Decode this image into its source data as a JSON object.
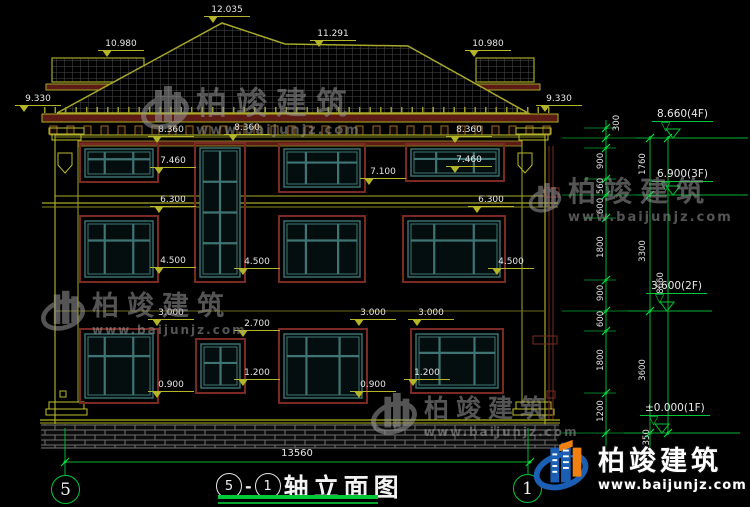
{
  "watermark": {
    "cn": "柏竣建筑",
    "url": "www.baijunjz.com"
  },
  "brand_logo": {
    "cn": "柏竣建筑",
    "url": "www.baijunjz.com"
  },
  "drawing_title": {
    "axis_start": "5",
    "sep": "-",
    "axis_end": "1",
    "name": "轴立面图"
  },
  "axis_bubbles": {
    "left": "5",
    "right": "1"
  },
  "bottom_dim": "13560",
  "levels": [
    {
      "label": "8.660(4F)"
    },
    {
      "label": "6.900(3F)"
    },
    {
      "label": "3.600(2F)"
    },
    {
      "label": "±0.000(1F)"
    }
  ],
  "facade_marks": [
    "12.035",
    "10.980",
    "11.291",
    "10.980",
    "9.330",
    "9.330",
    "8.360",
    "8.360",
    "8.360",
    "7.460",
    "7.460",
    "7.100",
    "6.300",
    "6.300",
    "4.500",
    "4.500",
    "4.500",
    "3.000",
    "3.000",
    "3.000",
    "2.700",
    "1.200",
    "1.200",
    "0.900",
    "0.900"
  ],
  "vertical_dims": [
    "300",
    "900",
    "560",
    "600",
    "1800",
    "900",
    "600",
    "1800",
    "1200",
    "1350",
    "1760",
    "3300",
    "3600",
    "8660"
  ]
}
